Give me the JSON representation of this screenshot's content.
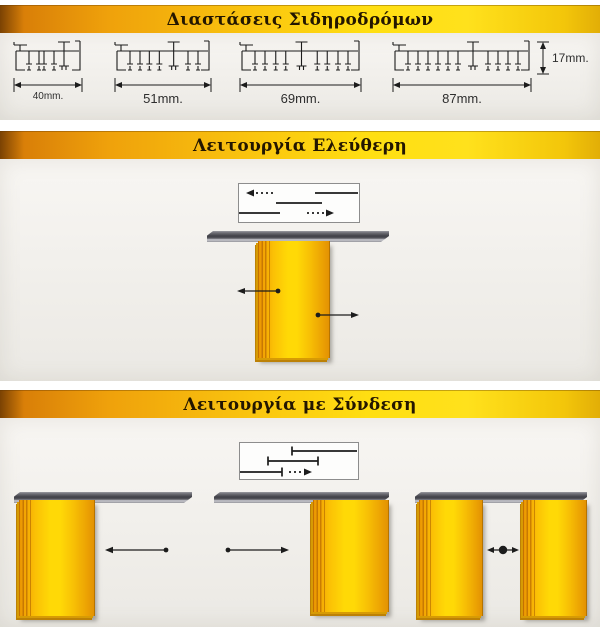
{
  "page": {
    "banner_dimensions": "Διαστάσεις Σιδηροδρόμων",
    "banner_free": "Λειτουργία Ελεύθερη",
    "banner_connected": "Λειτουργία με Σύνδεση"
  },
  "profiles": {
    "items": [
      {
        "label": "40mm.",
        "w": 72,
        "pattern": [
          "legs",
          "legs",
          "tpost"
        ]
      },
      {
        "label": "51mm.",
        "w": 100,
        "pattern": [
          "legs",
          "legs",
          "tpost",
          "legs"
        ]
      },
      {
        "label": "69mm.",
        "w": 125,
        "pattern": [
          "legs",
          "legs",
          "tpost",
          "legs",
          "legs"
        ]
      },
      {
        "label": "87mm.",
        "w": 142,
        "pattern": [
          "legs",
          "legs",
          "legs",
          "tpost",
          "legs",
          "legs"
        ]
      }
    ],
    "height_label": "17mm."
  },
  "colors": {
    "banner_orange": "#e5890a",
    "banner_yellow": "#ffdf12",
    "section_bg": "#f2f0ec",
    "panel_orange": "#ef9a02",
    "panel_yellow": "#ffd906",
    "rail_gray": "#3f3f46",
    "line_black": "#1c1c1c"
  }
}
